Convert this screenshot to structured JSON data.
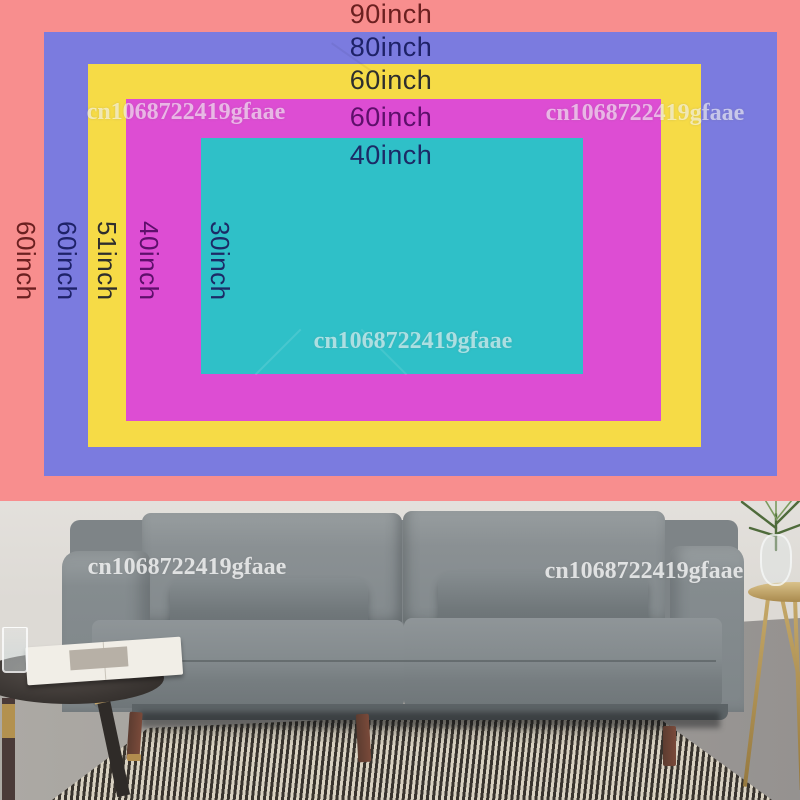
{
  "diagram": {
    "sizes": [
      {
        "top_label": "90inch",
        "side_label": "60inch",
        "color": "#F88E8E",
        "label_color": "#6B2020"
      },
      {
        "top_label": "80inch",
        "side_label": "60inch",
        "color": "#7B7BDF",
        "label_color": "#1E2268"
      },
      {
        "top_label": "60inch",
        "side_label": "51inch",
        "color": "#F6DB46",
        "label_color": "#2E2E2E"
      },
      {
        "top_label": "60inch",
        "side_label": "40inch",
        "color": "#DD4DD3",
        "label_color": "#5E0F6B"
      },
      {
        "top_label": "40inch",
        "side_label": "30inch",
        "color": "#2FC0C8",
        "label_color": "#1C2A66"
      }
    ]
  },
  "watermark": {
    "text": "cn1068722419gfaae"
  }
}
